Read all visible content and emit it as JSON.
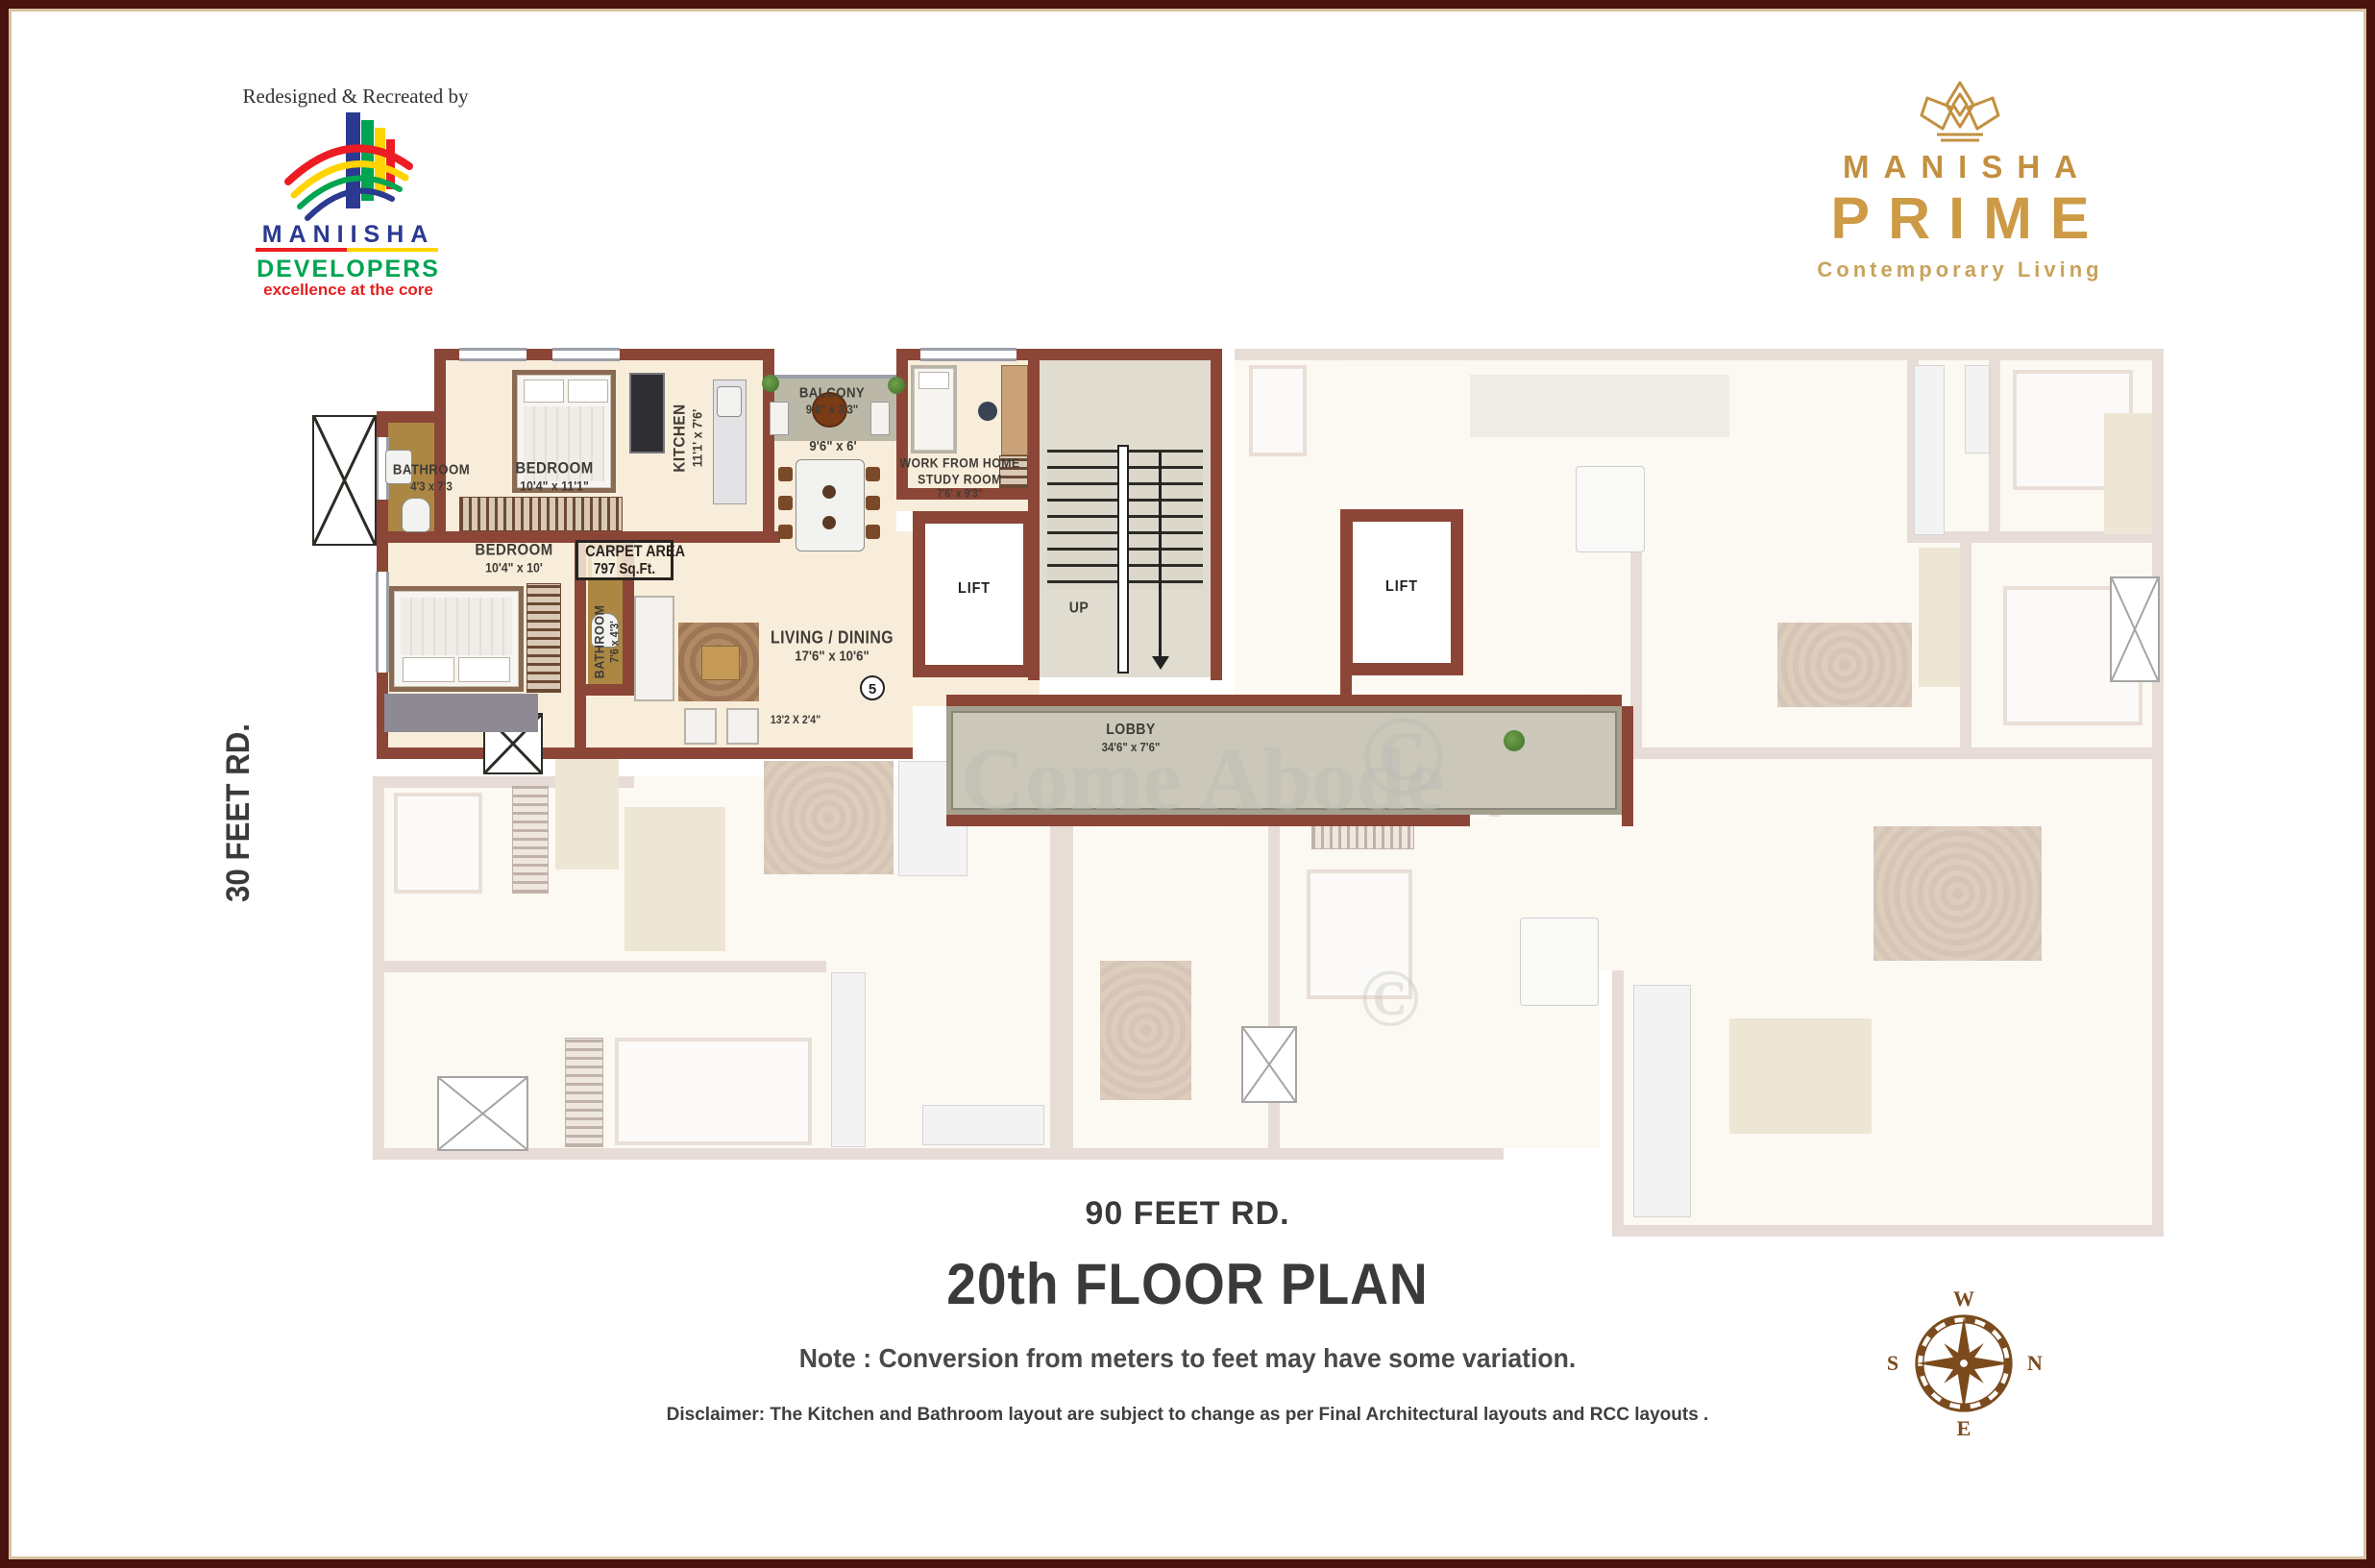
{
  "header": {
    "credit": "Redesigned & Recreated by"
  },
  "developer": {
    "name": "MANIISHA",
    "type": "DEVELOPERS",
    "tagline": "excellence at the core",
    "logo_icon": "rainbow-building-icon",
    "colors": {
      "blue": "#2B3990",
      "green": "#00A551",
      "yellow": "#FFD400",
      "red": "#ED1C24"
    }
  },
  "brand": {
    "name": "MANISHA",
    "product": "PRIME",
    "tagline": "Contemporary Living",
    "logo_icon": "crown-icon",
    "gold": "#C29040"
  },
  "roads": {
    "left": "30 FEET RD.",
    "bottom": "90 FEET RD."
  },
  "plan": {
    "bathroom1": {
      "name": "BATHROOM",
      "dim": "4'3 x 7'3"
    },
    "bedroom1": {
      "name": "BEDROOM",
      "dim": "10'4\" x 11'1\""
    },
    "kitchen": {
      "name": "KITCHEN",
      "dim": "11'1' x 7'6'"
    },
    "bedroom2": {
      "name": "BEDROOM",
      "dim": "10'4\" x 10'"
    },
    "bathroom2": {
      "name": "BATHROOM",
      "dim": "7'6 x 4'3'"
    },
    "carpet_area": {
      "line1": "CARPET AREA",
      "line2": "797 Sq.Ft."
    },
    "balcony": {
      "name": "BALCONY",
      "dim": "9'6\" x 3'3\""
    },
    "dining_dim": "9'6\" x 6'",
    "wfh": {
      "line1": "WORK FROM HOME",
      "line2": "STUDY ROOM",
      "dim": "7'6' x 9'3\""
    },
    "living": {
      "name": "LIVING / DINING",
      "dim": "17'6\" x 10'6\""
    },
    "passage_dim": "13'2 X 2'4\"",
    "unit_number": "5",
    "lift": "LIFT",
    "up": "UP",
    "lobby": {
      "name": "LOBBY",
      "dim": "34'6\" x 7'6\""
    },
    "wall_color": "#8C4637",
    "frame_color": "#4A130D",
    "carpet_area_value": "797 Sq.Ft."
  },
  "footer": {
    "title": "20th FLOOR PLAN",
    "note": "Note : Conversion from meters to feet may have some variation.",
    "disclaimer": "Disclaimer: The Kitchen and Bathroom layout are subject to change as per Final Architectural layouts  and RCC layouts ."
  },
  "compass": {
    "top": "W",
    "right": "N",
    "bottom": "E",
    "left": "S"
  },
  "watermark": {
    "text": "Come Abode",
    "symbol": "©"
  }
}
